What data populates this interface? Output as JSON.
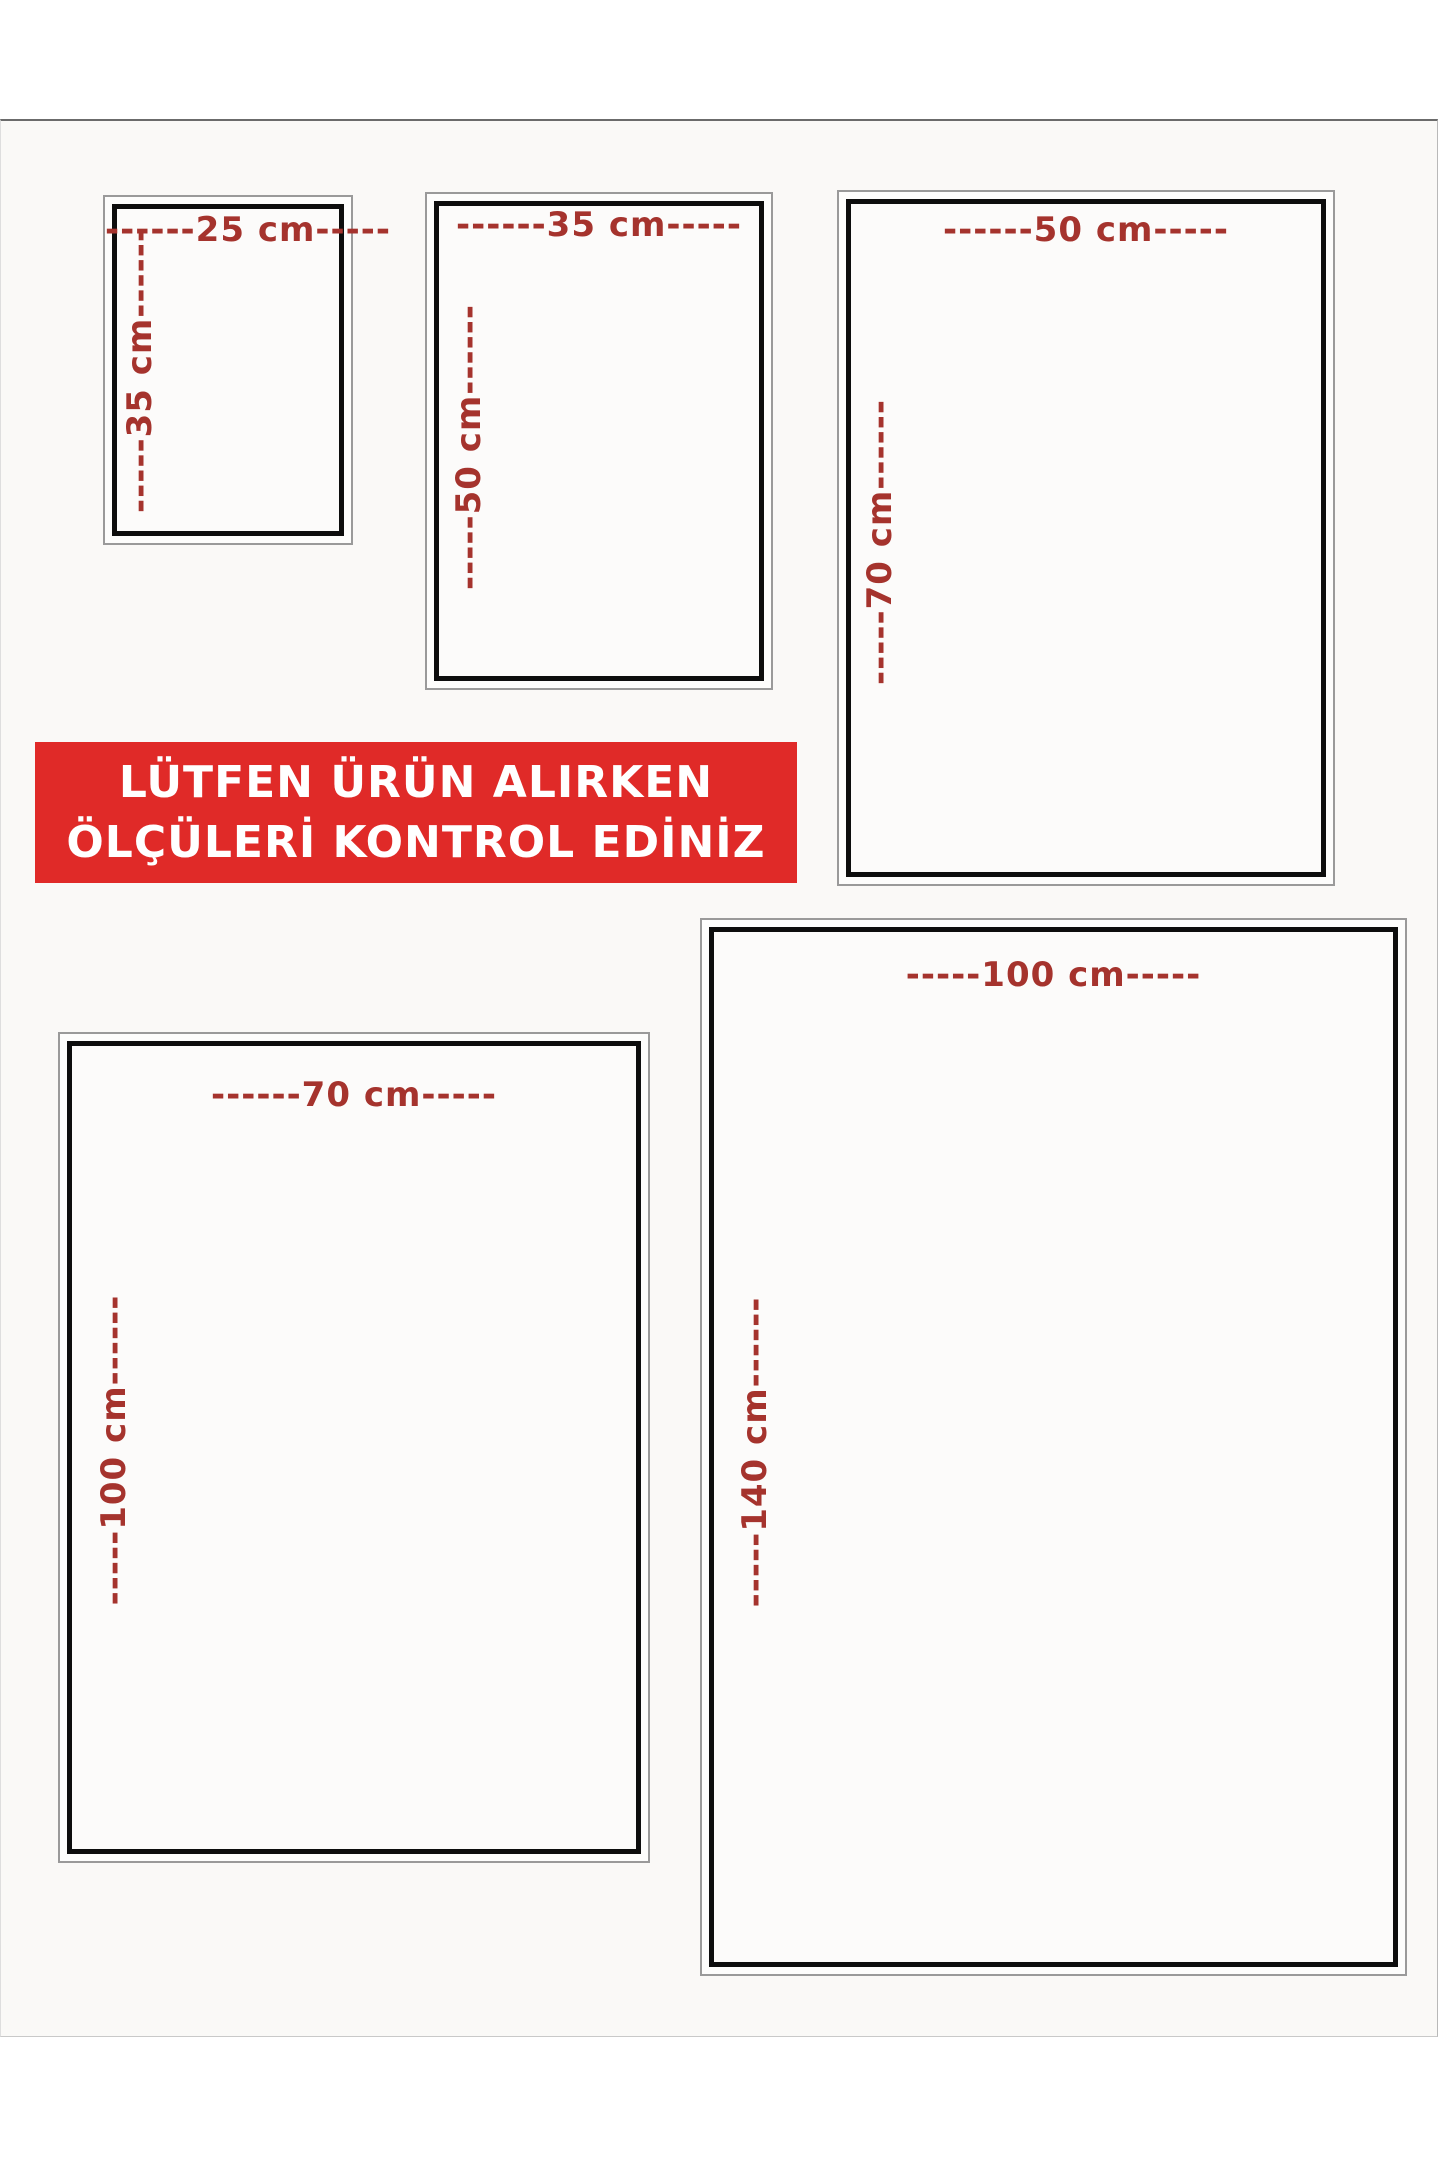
{
  "unit": "cm",
  "accent_color": "#a5332d",
  "banner": {
    "line1": "LÜTFEN ÜRÜN ALIRKEN",
    "line2": "ÖLÇÜLERİ KONTROL EDİNİZ",
    "background_color": "#e02a28",
    "text_color": "#ffffff"
  },
  "sizes": [
    {
      "name": "25x35",
      "width_cm": 25,
      "height_cm": 35,
      "width_label": "------25 cm-----",
      "height_label": "-----35 cm------"
    },
    {
      "name": "35x50",
      "width_cm": 35,
      "height_cm": 50,
      "width_label": "------35 cm-----",
      "height_label": "-----50 cm------"
    },
    {
      "name": "50x70",
      "width_cm": 50,
      "height_cm": 70,
      "width_label": "------50 cm-----",
      "height_label": "-----70 cm------"
    },
    {
      "name": "70x100",
      "width_cm": 70,
      "height_cm": 100,
      "width_label": "------70 cm-----",
      "height_label": "-----100 cm------"
    },
    {
      "name": "100x140",
      "width_cm": 100,
      "height_cm": 140,
      "width_label": "-----100 cm-----",
      "height_label": "-----140 cm------"
    }
  ]
}
